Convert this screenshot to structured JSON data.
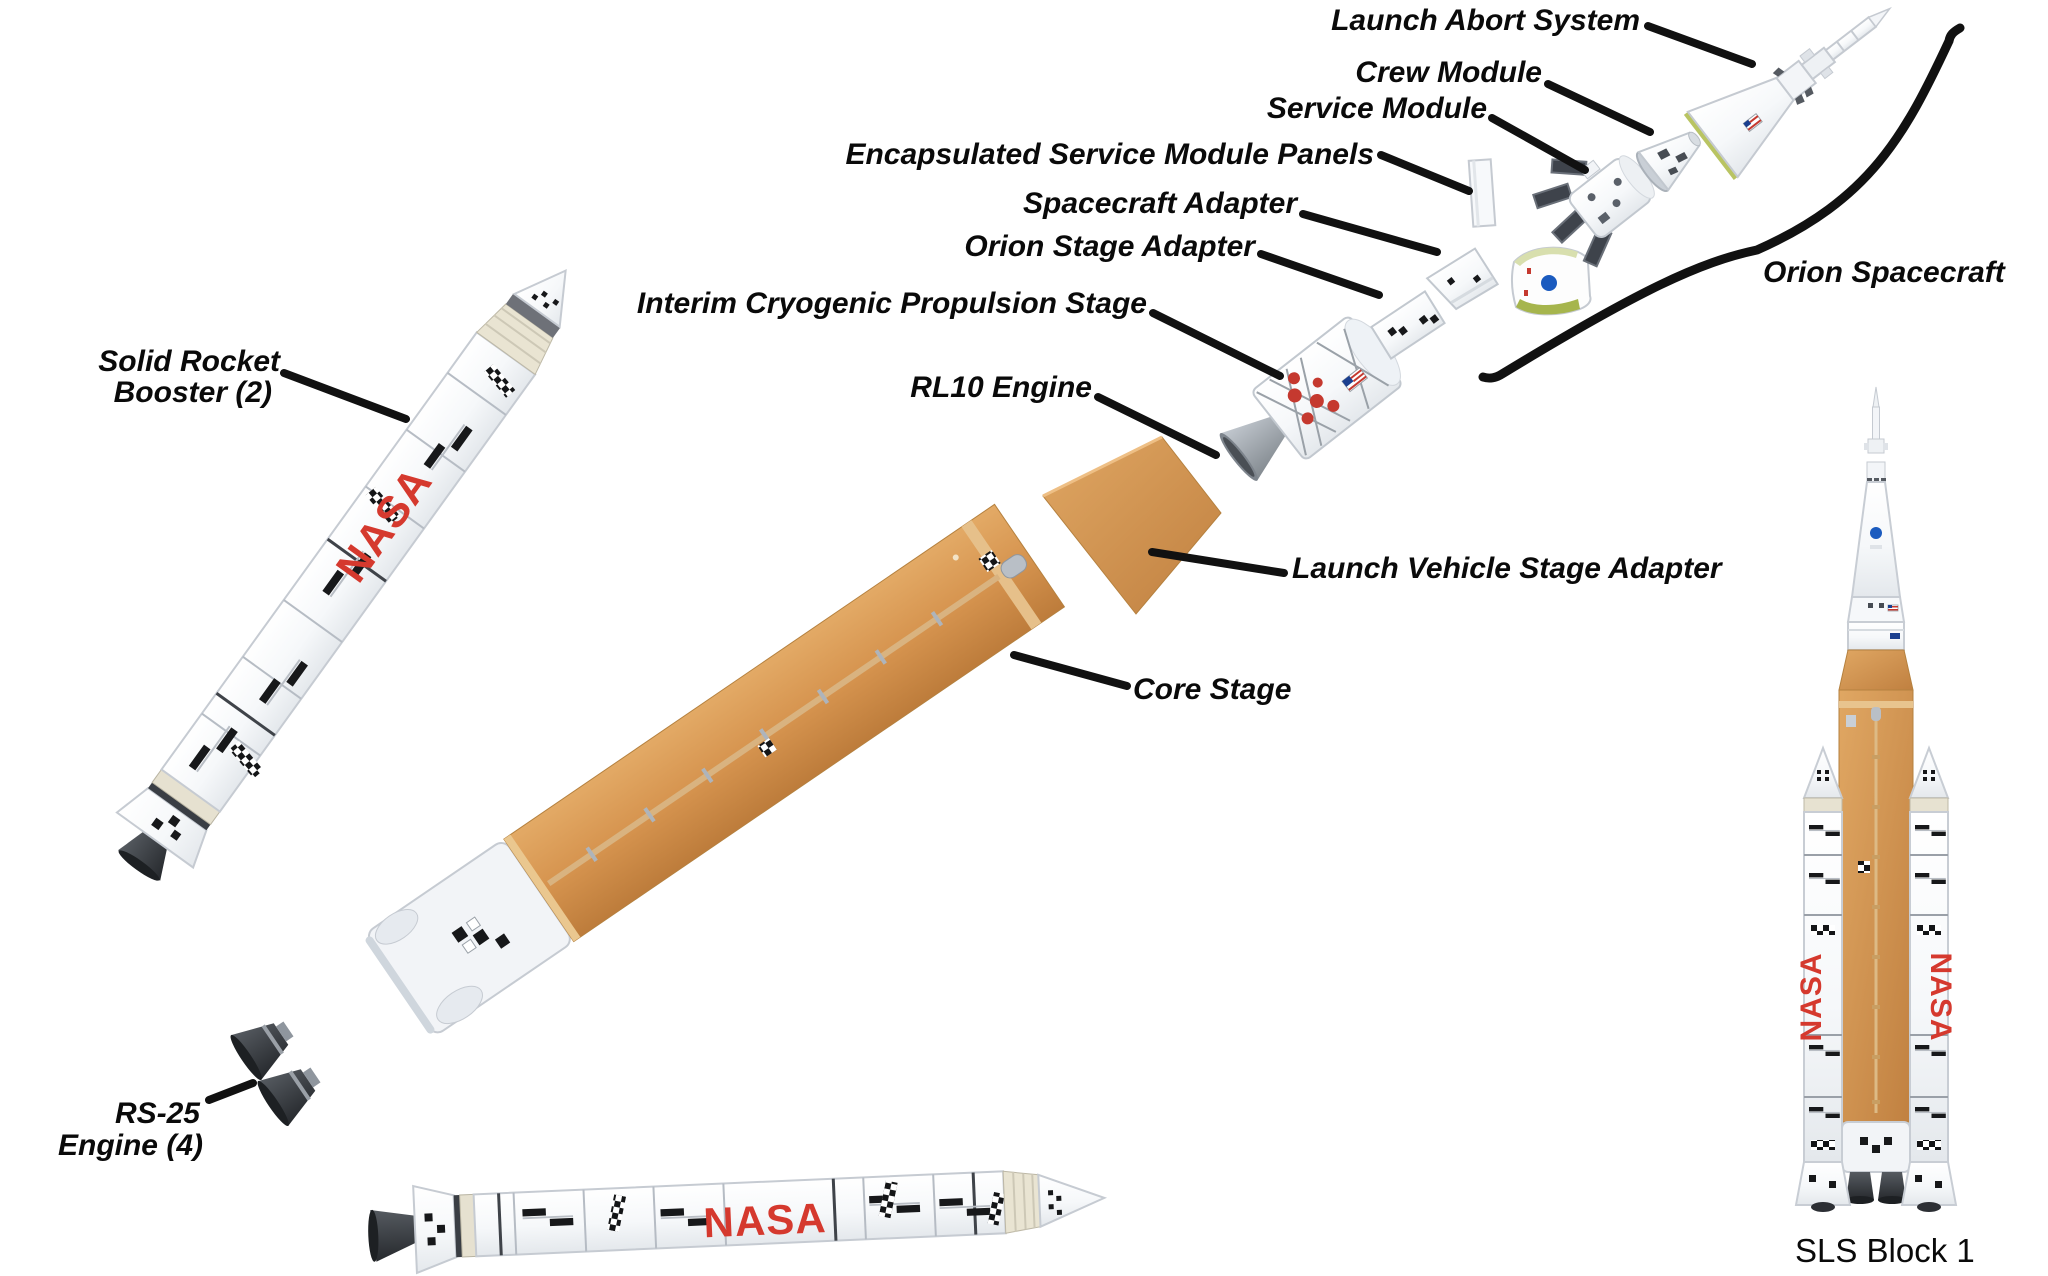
{
  "labels": {
    "launch_abort_system": "Launch Abort System",
    "crew_module": "Crew Module",
    "service_module": "Service Module",
    "esm_panels": "Encapsulated Service Module Panels",
    "spacecraft_adapter": "Spacecraft Adapter",
    "orion_stage_adapter": "Orion Stage Adapter",
    "icps": "Interim Cryogenic Propulsion Stage",
    "rl10_engine": "RL10 Engine",
    "orion_spacecraft": "Orion Spacecraft",
    "srb": {
      "line1": "Solid Rocket",
      "line2": "Booster (2)"
    },
    "lvsa": "Launch Vehicle Stage Adapter",
    "core_stage": "Core Stage",
    "rs25": {
      "line1": "RS-25",
      "line2": "Engine (4)"
    },
    "sls_block_1": "SLS Block 1"
  },
  "logos": {
    "nasa_worm": "NASA"
  },
  "colors": {
    "leader": "#111111",
    "text": "#0a0a0a",
    "worm_red": "#d5392e",
    "tank_orange_light": "#e3aa66",
    "tank_orange": "#d6944f",
    "tank_orange_dark": "#bd7c3b",
    "white_part": "#ffffff",
    "part_outline": "#c6cbd2",
    "nozzle_dark": "#33373d",
    "metal_gray": "#9aa1a8",
    "meatball_blue": "#1b5bbf",
    "panel_green": "#a6b54d"
  }
}
